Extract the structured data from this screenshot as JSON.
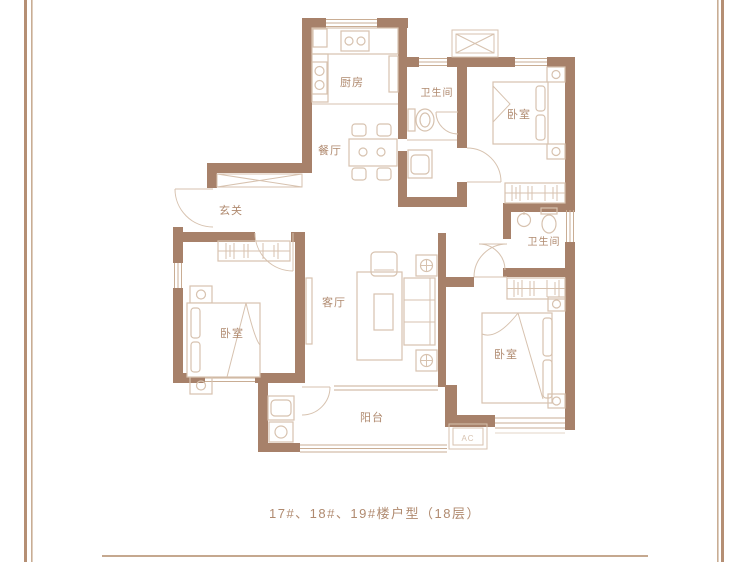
{
  "plan": {
    "labels": {
      "kitchen": "厨房",
      "bath_top": "卫生间",
      "bedroom_top_right": "卧室",
      "dining": "餐厅",
      "foyer": "玄关",
      "bath_mid": "卫生间",
      "living": "客厅",
      "bedroom_left": "卧室",
      "bedroom_bottom_right": "卧室",
      "balcony": "阳台",
      "ac_unit": "AC"
    },
    "colors": {
      "wall": "#a7816a",
      "furniture": "#d7c2af",
      "window": "#c9ad94",
      "label": "#b08a6f",
      "border": "#b58f74",
      "rule": "#c5a88f"
    }
  },
  "caption": {
    "text": "17#、18#、19#楼户型（18层）"
  }
}
